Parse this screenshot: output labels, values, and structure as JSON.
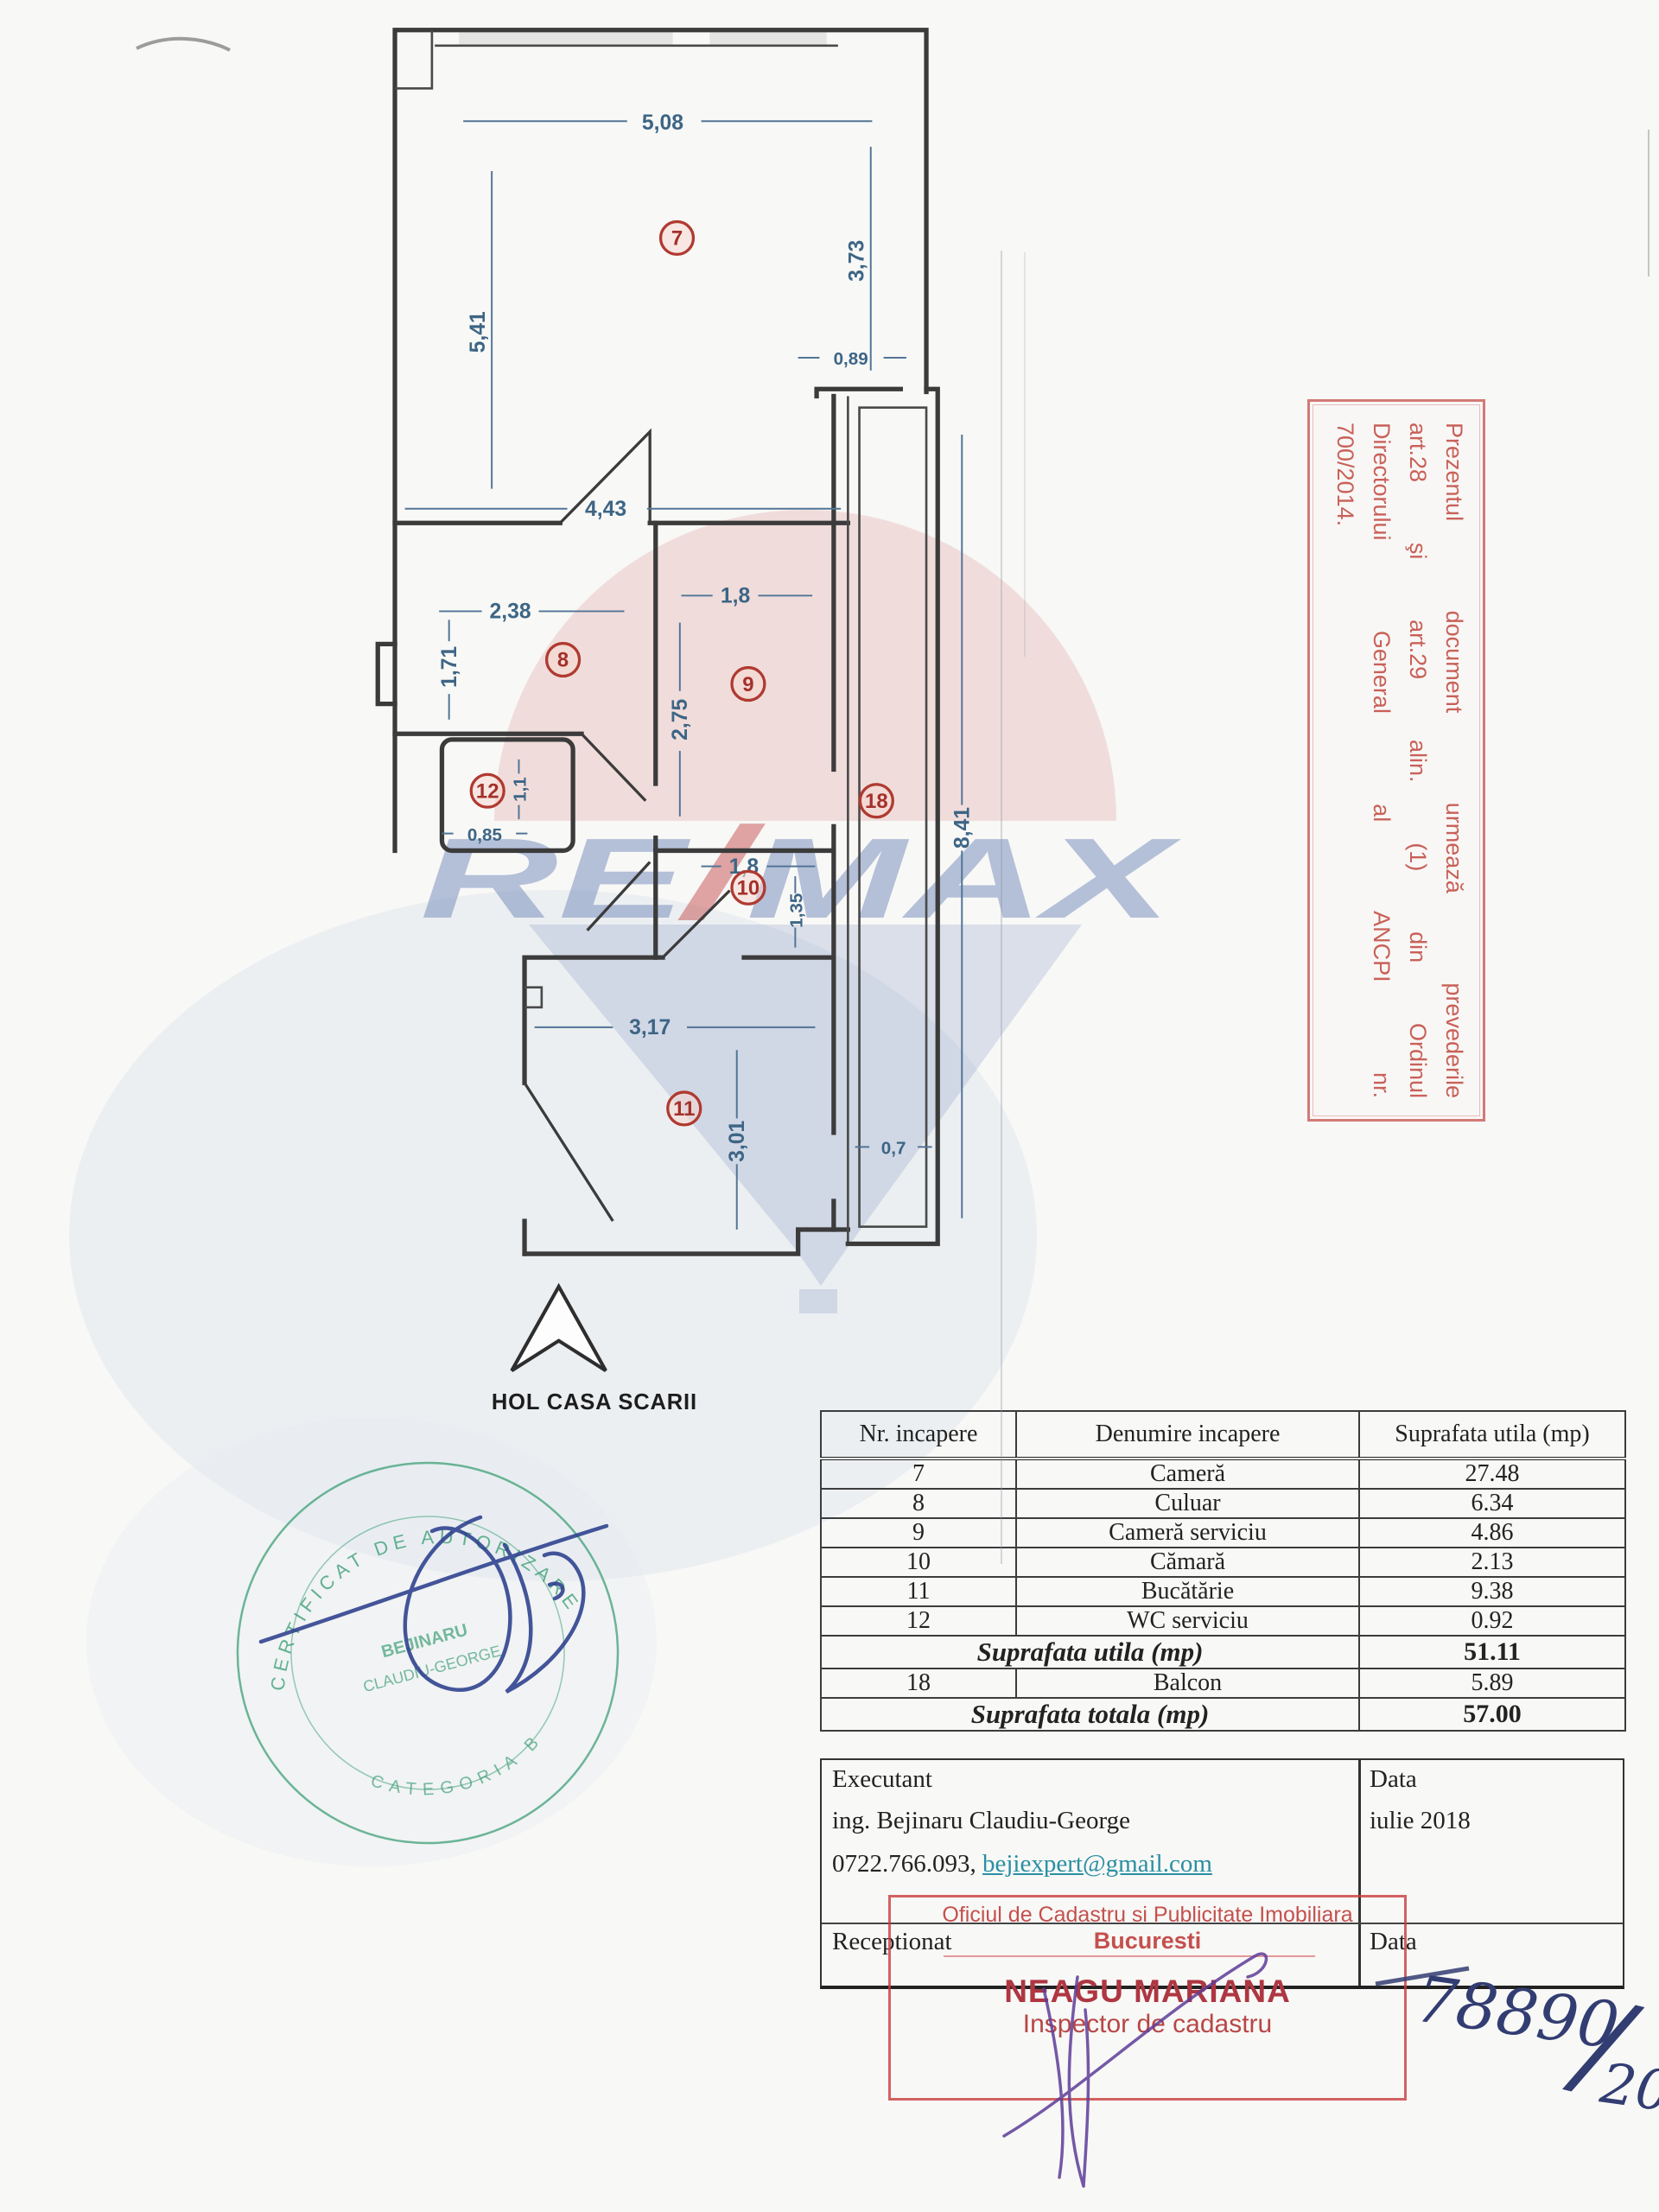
{
  "plan": {
    "stairwell_label": "HOL CASA SCARII",
    "rooms": {
      "r7": "7",
      "r8": "8",
      "r9": "9",
      "r10": "10",
      "r11": "11",
      "r12": "12",
      "r18": "18"
    },
    "dims": {
      "w508": "5,08",
      "w541": "5,41",
      "w373": "3,73",
      "w089": "0,89",
      "w443": "4,43",
      "w238": "2,38",
      "w171": "1,71",
      "w18a": "1,8",
      "w275": "2,75",
      "w11": "1,1",
      "w085": "0,85",
      "w18b": "1,8",
      "w135": "1,35",
      "w317": "3,17",
      "w301": "3,01",
      "w07": "0,7",
      "w841": "8,41"
    }
  },
  "watermark": {
    "re": "RE",
    "slash": "/",
    "max": "MAX"
  },
  "side_stamp": {
    "line1": "Prezentul document urmează prevederile",
    "line2": "art.28 şi art.29 alin. (1) din Ordinul",
    "line3": "Directorului General al ANCPI nr.",
    "line4": "700/2014."
  },
  "table": {
    "headers": [
      "Nr. incapere",
      "Denumire incapere",
      "Suprafata utila (mp)"
    ],
    "rows": [
      [
        "7",
        "Cameră",
        "27.48"
      ],
      [
        "8",
        "Culuar",
        "6.34"
      ],
      [
        "9",
        "Cameră serviciu",
        "4.86"
      ],
      [
        "10",
        "Cămară",
        "2.13"
      ],
      [
        "11",
        "Bucătărie",
        "9.38"
      ],
      [
        "12",
        "WC serviciu",
        "0.92"
      ]
    ],
    "utila_label": "Suprafata utila (mp)",
    "utila_value": "51.11",
    "balcon_row": [
      "18",
      "Balcon",
      "5.89"
    ],
    "totala_label": "Suprafata totala (mp)",
    "totala_value": "57.00"
  },
  "footer": {
    "executant_label": "Executant",
    "executant_name": "ing. Bejinaru Claudiu-George",
    "executant_phone": "0722.766.093,",
    "executant_email": "bejiexpert@gmail.com",
    "data_label": "Data",
    "data_value": "iulie 2018",
    "receptionat_label": "Receptionat",
    "receptionat_data_label": "Data"
  },
  "ocpi_stamp": {
    "line1": "Oficiul de Cadastru si Publicitate Imobiliara",
    "line2": "Bucuresti",
    "name": "NEAGU MARIANA",
    "role": "Inspector de cadastru"
  },
  "handwriting": {
    "part1": "78890",
    "slash": "/",
    "part2": "2018"
  },
  "green_stamp": {
    "arc_top": "CERTIFICAT DE AUTORIZARE",
    "arc_bottom": "CATEGORIA B",
    "name1": "BEJINARU",
    "name2": "CLAUDIU-GEORGE"
  }
}
